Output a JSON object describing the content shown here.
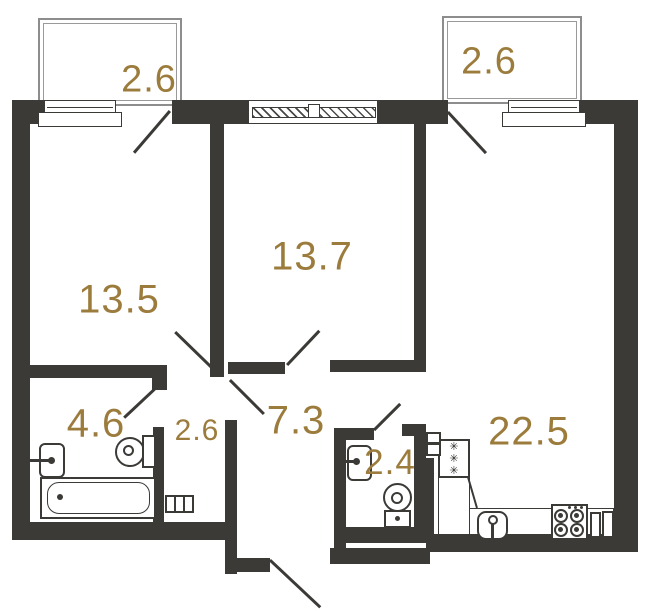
{
  "title": "Apartment floor plan",
  "colors": {
    "wall": "#3c3a37",
    "label": "#9c7c3c",
    "balcony_line": "#8d8d8d"
  },
  "icons": {
    "fridge_star": "✳"
  },
  "rooms": [
    {
      "id": "balcony_left",
      "area": "2.6"
    },
    {
      "id": "balcony_right",
      "area": "2.6"
    },
    {
      "id": "room_13_5",
      "area": "13.5"
    },
    {
      "id": "room_13_7",
      "area": "13.7"
    },
    {
      "id": "bathroom",
      "area": "4.6"
    },
    {
      "id": "closet",
      "area": "2.6"
    },
    {
      "id": "hallway",
      "area": "7.3"
    },
    {
      "id": "wc",
      "area": "2.4"
    },
    {
      "id": "kitchen_living",
      "area": "22.5"
    }
  ]
}
